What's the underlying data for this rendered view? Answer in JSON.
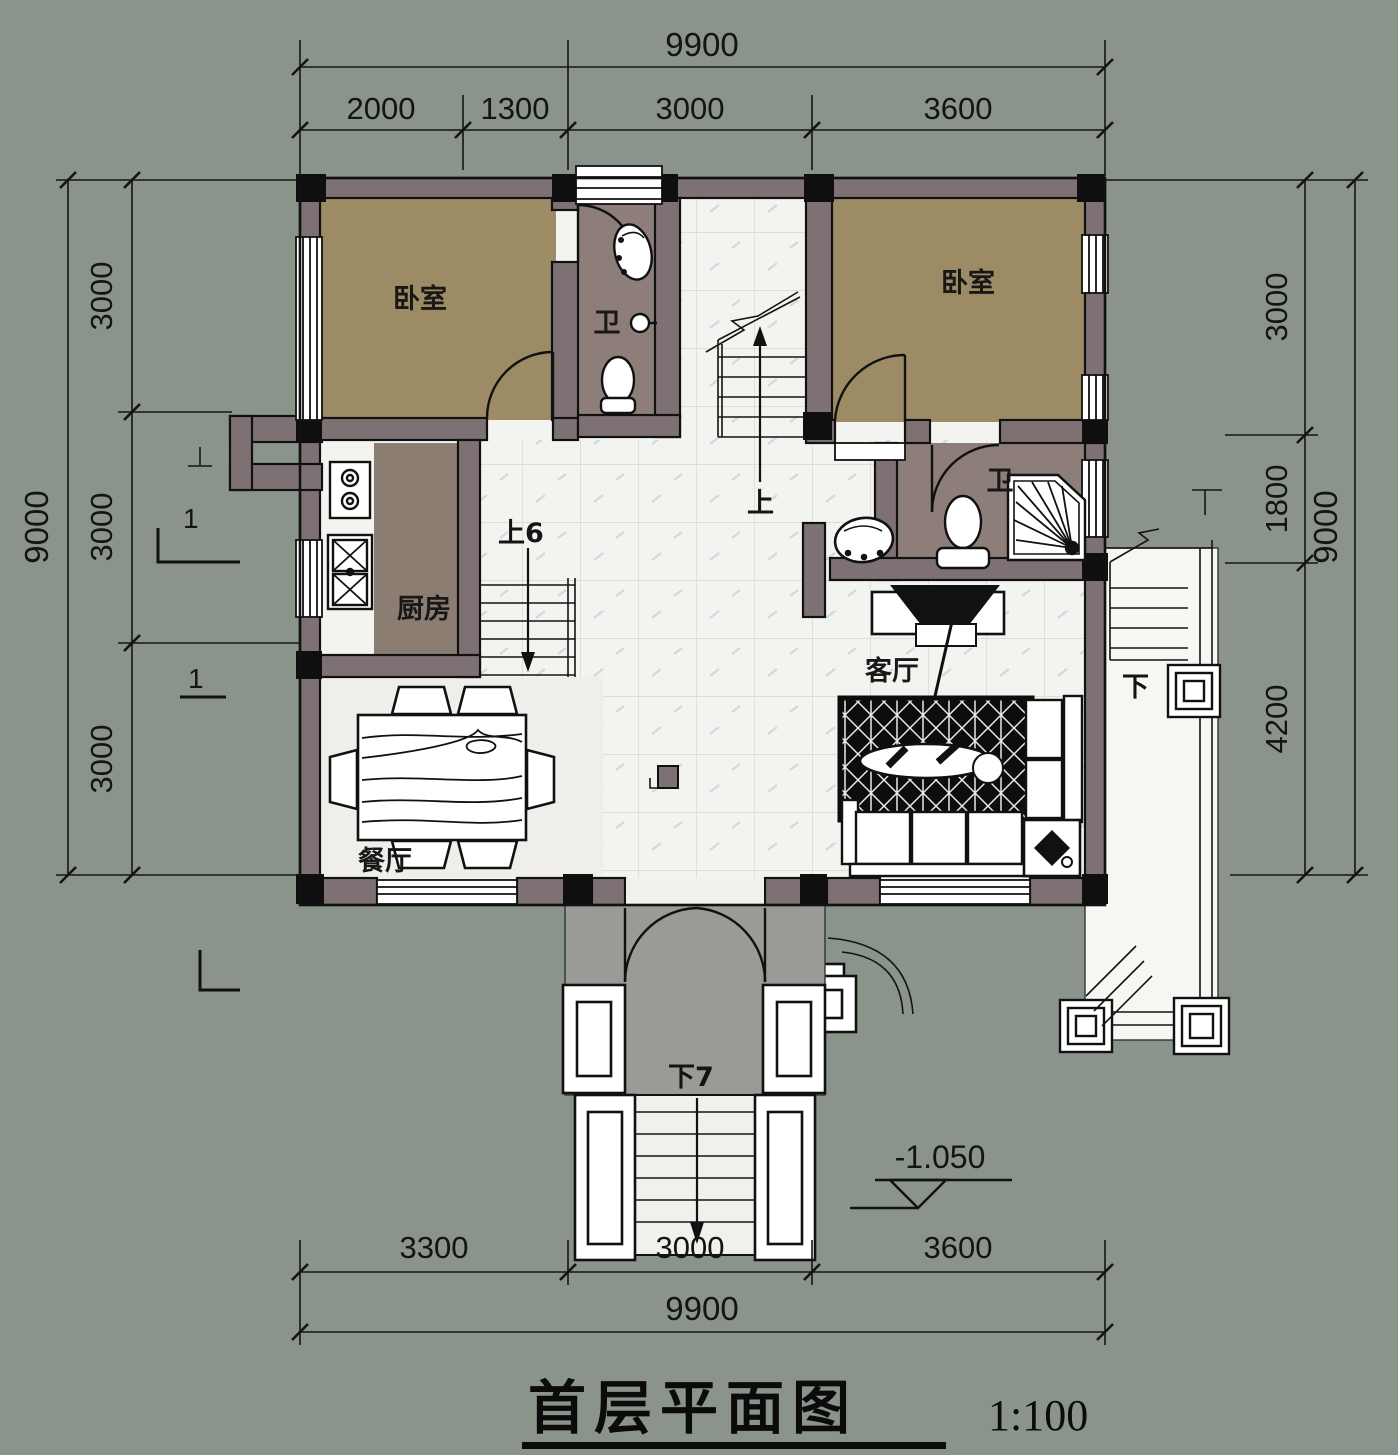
{
  "drawing": {
    "title": "首层平面图",
    "scale": "1:100"
  },
  "dimensions": {
    "top": {
      "total": "9900",
      "segments": [
        "2000",
        "1300",
        "3000",
        "3600"
      ]
    },
    "bottom": {
      "total": "9900",
      "segments": [
        "3300",
        "3000",
        "3600"
      ]
    },
    "left": {
      "total": "9000",
      "segments": [
        "3000",
        "3000",
        "3000"
      ]
    },
    "right": {
      "total": "9000",
      "segments": [
        "3000",
        "1800",
        "4200"
      ]
    }
  },
  "labels": {
    "bedroom_left": "卧室",
    "bedroom_right": "卧室",
    "bath_top": "卫",
    "bath_right": "卫",
    "kitchen": "厨房",
    "living_room": "客厅",
    "dining_room": "餐厅",
    "stair_up": "上",
    "stair_up6": "上6",
    "entry_down7": "下7",
    "terrace_down": "下",
    "level_mark": "-1.050",
    "section_mark": "1"
  },
  "palette": {
    "background": "#8a948a",
    "wall": "#7e7174",
    "wall_dark": "#0f0f0f",
    "bedroom_floor": "#9c8b64",
    "bath_floor": "#8d7e79",
    "kitchen_floor": "#8c7d72",
    "tile": "#f3f3f0",
    "dining_floor": "#efeeea",
    "porch_floor": "#9a9b96",
    "terrace_floor": "#f6f6f3"
  }
}
